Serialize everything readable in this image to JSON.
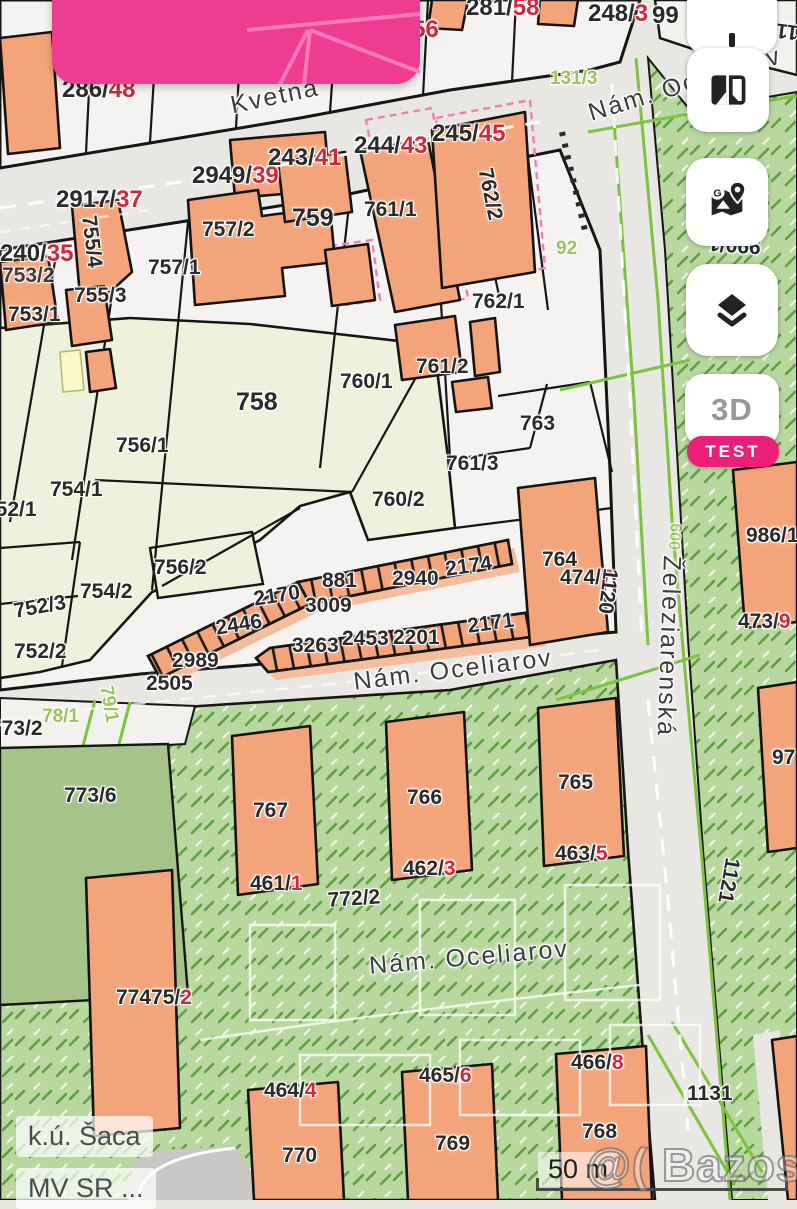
{
  "map": {
    "streets": {
      "kvetna": "Kvetná",
      "nam_oceliarov_top": "Nám. Oceliarov",
      "nam_oceliarov_mid": "Nám. Oceliarov",
      "nam_oceliarov_bottom": "Nám. Oceliarov",
      "zeleziarenska": "Železiarenská"
    },
    "labels": [
      {
        "t": "286/",
        "r": "48"
      },
      {
        "t": "285/",
        "r": "50"
      },
      {
        "t": "284/",
        "r": "52"
      },
      {
        "t": "283/",
        "r": "54"
      },
      {
        "t": "2439/",
        "r": "56"
      },
      {
        "t": "281/",
        "r": "58"
      },
      {
        "t": "248/",
        "r": "3"
      },
      {
        "t": "99",
        "r": ""
      },
      {
        "t": "2917/",
        "r": "37"
      },
      {
        "t": "2949/",
        "r": "39"
      },
      {
        "t": "243/",
        "r": "41"
      },
      {
        "t": "244/",
        "r": "43"
      },
      {
        "t": "245/",
        "r": "45"
      },
      {
        "t": "240/",
        "r": "35"
      },
      {
        "t": "753/2",
        "r": ""
      },
      {
        "t": "755/4",
        "r": ""
      },
      {
        "t": "757/2",
        "r": ""
      },
      {
        "t": "757/1",
        "r": ""
      },
      {
        "t": "755/3",
        "r": ""
      },
      {
        "t": "753/1",
        "r": ""
      },
      {
        "t": "759",
        "r": ""
      },
      {
        "t": "761/1",
        "r": ""
      },
      {
        "t": "762/2",
        "r": ""
      },
      {
        "t": "762/1",
        "r": ""
      },
      {
        "t": "761/2",
        "r": ""
      },
      {
        "t": "760/1",
        "r": ""
      },
      {
        "t": "758",
        "r": ""
      },
      {
        "t": "763",
        "r": ""
      },
      {
        "t": "761/3",
        "r": ""
      },
      {
        "t": "760/2",
        "r": ""
      },
      {
        "t": "756/1",
        "r": ""
      },
      {
        "t": "754/1",
        "r": ""
      },
      {
        "t": "752/1",
        "r": ""
      },
      {
        "t": "756/2",
        "r": ""
      },
      {
        "t": "754/2",
        "r": ""
      },
      {
        "t": "752/3",
        "r": ""
      },
      {
        "t": "752/2",
        "r": ""
      },
      {
        "t": "764",
        "r": ""
      },
      {
        "t": "474/",
        "r": "7"
      },
      {
        "t": "986/1",
        "r": ""
      },
      {
        "t": "473/",
        "r": "9"
      },
      {
        "t": "881",
        "r": ""
      },
      {
        "t": "2940",
        "r": ""
      },
      {
        "t": "2174",
        "r": ""
      },
      {
        "t": "2170",
        "r": ""
      },
      {
        "t": "3009",
        "r": ""
      },
      {
        "t": "2446",
        "r": ""
      },
      {
        "t": "2989",
        "r": ""
      },
      {
        "t": "2505",
        "r": ""
      },
      {
        "t": "3263",
        "r": ""
      },
      {
        "t": "2453",
        "r": ""
      },
      {
        "t": "2201",
        "r": ""
      },
      {
        "t": "2171",
        "r": ""
      },
      {
        "t": "773/2",
        "r": ""
      },
      {
        "t": "773/6",
        "r": ""
      },
      {
        "t": "767",
        "r": ""
      },
      {
        "t": "766",
        "r": ""
      },
      {
        "t": "765",
        "r": ""
      },
      {
        "t": "461/",
        "r": "1"
      },
      {
        "t": "462/",
        "r": "3"
      },
      {
        "t": "463/",
        "r": "5"
      },
      {
        "t": "772/2",
        "r": ""
      },
      {
        "t": "77475/",
        "r": "2"
      },
      {
        "t": "464/",
        "r": "4"
      },
      {
        "t": "465/",
        "r": "6"
      },
      {
        "t": "466/",
        "r": "8"
      },
      {
        "t": "770",
        "r": ""
      },
      {
        "t": "769",
        "r": ""
      },
      {
        "t": "768",
        "r": ""
      },
      {
        "t": "1131",
        "r": ""
      },
      {
        "t": "1121",
        "r": ""
      },
      {
        "t": "1120",
        "r": ""
      },
      {
        "t": "1101/5",
        "r": ""
      },
      {
        "t": "990/1",
        "r": ""
      },
      {
        "t": "97",
        "r": ""
      }
    ],
    "green_labels": [
      "131/3",
      "92",
      "78/1",
      "79/1",
      "600"
    ],
    "colors": {
      "building": "#f4a47a",
      "highlight_pink": "#ee3d90",
      "label_red": "#cf2838",
      "greenery": "#b9d8a0",
      "garden": "#ecf2db",
      "utility_green": "#7cc33e"
    }
  },
  "controls": {
    "buttons": [
      {
        "name": "partial-top-button",
        "icon": "partial-icon"
      },
      {
        "name": "compare-maps-button",
        "icon": "compare-maps-icon"
      },
      {
        "name": "google-maps-button",
        "icon": "google-maps-icon"
      },
      {
        "name": "layers-button",
        "icon": "layers-icon"
      },
      {
        "name": "threed-button",
        "label": "3D",
        "badge": "TEST"
      }
    ],
    "threed_label": "3D",
    "test_label": "TEST"
  },
  "footer": {
    "area_label": "k.ú. Šaca",
    "source_label": "MV SR ...",
    "scale_label": "50 m",
    "watermark": "@( Bazos.sk"
  }
}
